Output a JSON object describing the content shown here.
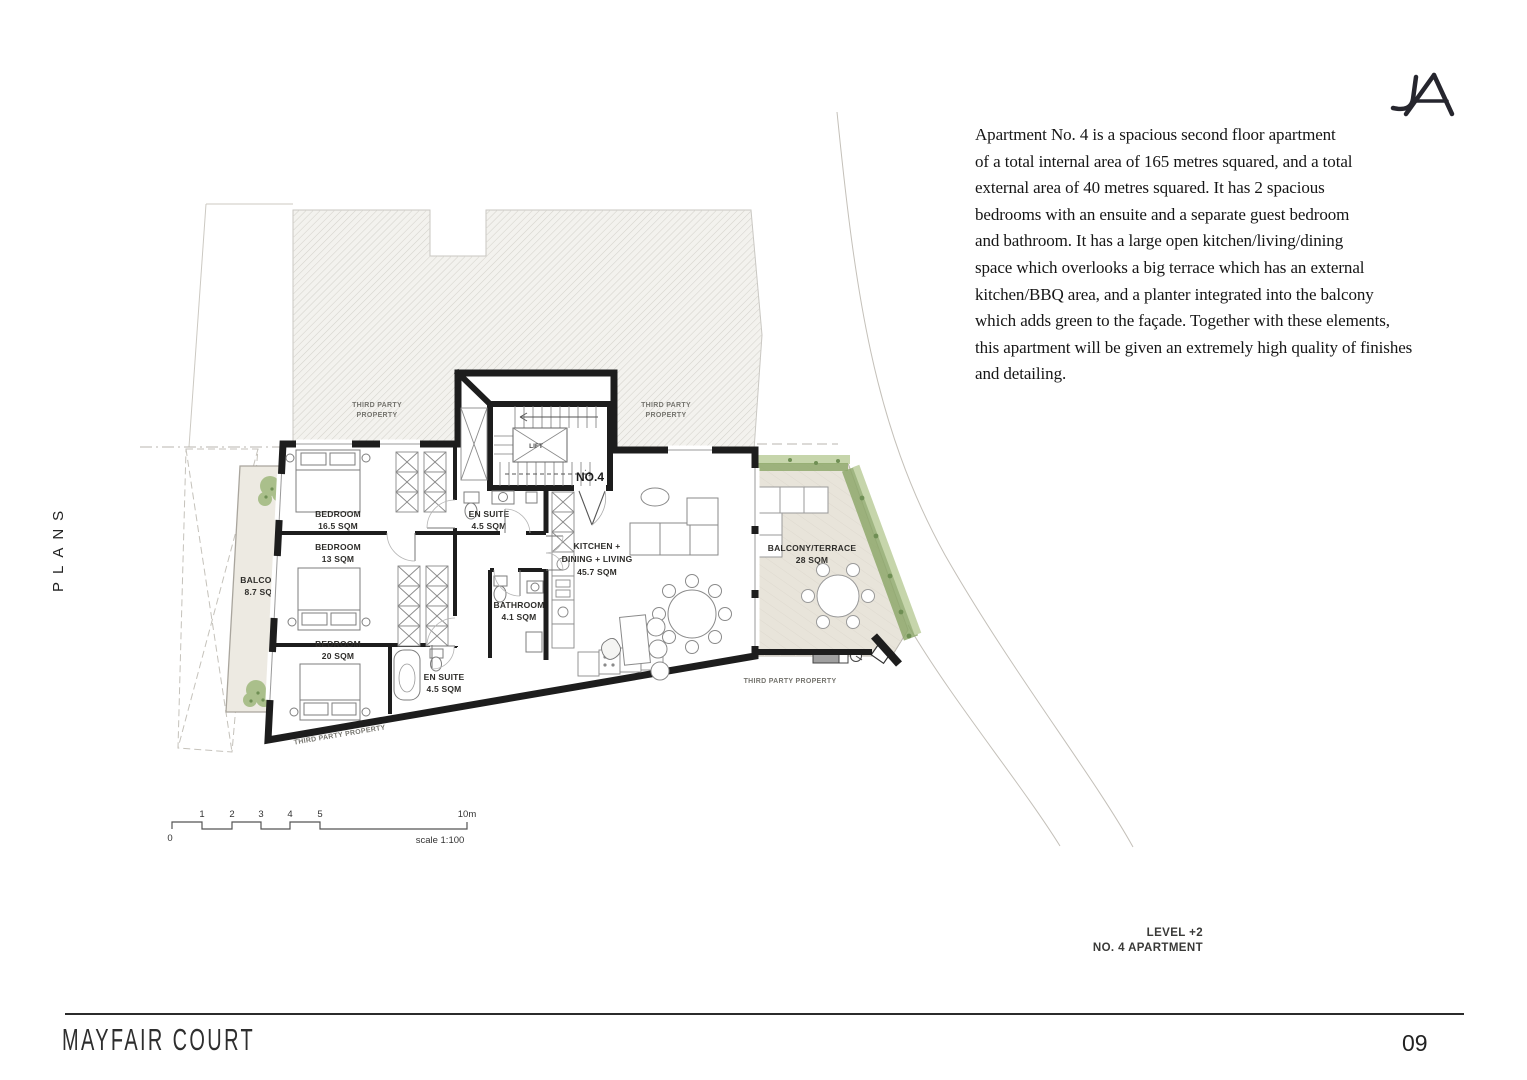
{
  "brand": {
    "logo": "JA"
  },
  "sidebar": {
    "label": "PLANS"
  },
  "description": {
    "lines": [
      "Apartment No. 4 is a spacious second floor apartment",
      "of a total internal area of 165 metres squared, and a total",
      "external area of 40 metres squared.  It has 2 spacious",
      "bedrooms with an ensuite and a separate guest bedroom",
      "and bathroom. It has a large open kitchen/living/dining",
      "space which overlooks a big terrace which has an external",
      "kitchen/BBQ area, and a planter integrated into the balcony",
      "which adds green to the façade. Together with these elements,",
      "this apartment will be given an extremely high quality of finishes",
      "and detailing."
    ]
  },
  "plan": {
    "unit_label": "NO.4",
    "lift_label": "LIFT",
    "rooms": {
      "bedroom1": {
        "name": "BEDROOM",
        "area": "16.5 SQM"
      },
      "bedroom2": {
        "name": "BEDROOM",
        "area": "13 SQM"
      },
      "bedroom3": {
        "name": "BEDROOM",
        "area": "20 SQM"
      },
      "ensuite1": {
        "name": "EN SUITE",
        "area": "4.5 SQM"
      },
      "bathroom": {
        "name": "BATHROOM",
        "area": "4.1 SQM"
      },
      "ensuite2": {
        "name": "EN SUITE",
        "area": "4.5 SQM"
      },
      "kitchen": {
        "name_line1": "KITCHEN +",
        "name_line2": "DINING + LIVING",
        "area": "45.7 SQM"
      },
      "balcony": {
        "name": "BALCONY",
        "area": "8.7 SQM"
      },
      "terrace": {
        "name": "BALCONY/TERRACE",
        "area": "28 SQM"
      }
    },
    "third_party": {
      "line1": "THIRD PARTY",
      "line2": "PROPERTY",
      "single": "THIRD PARTY PROPERTY"
    },
    "scalebar": {
      "zero": "0",
      "ticks": [
        "1",
        "2",
        "3",
        "4",
        "5"
      ],
      "end": "10m",
      "label": "scale 1:100"
    }
  },
  "annotation": {
    "level": "LEVEL +2",
    "apartment": "NO. 4 APARTMENT"
  },
  "footer": {
    "title": "MAYFAIR COURT",
    "page": "09"
  },
  "colors": {
    "wall": "#1d1d1d",
    "hatch_line": "#d4d2cc",
    "hatch_bg": "#f3f2ee",
    "deck": "#e8e4da",
    "green_dark": "#8fa96c",
    "green_light": "#c6d5ab",
    "bbq_gray": "#a0a0a0"
  }
}
